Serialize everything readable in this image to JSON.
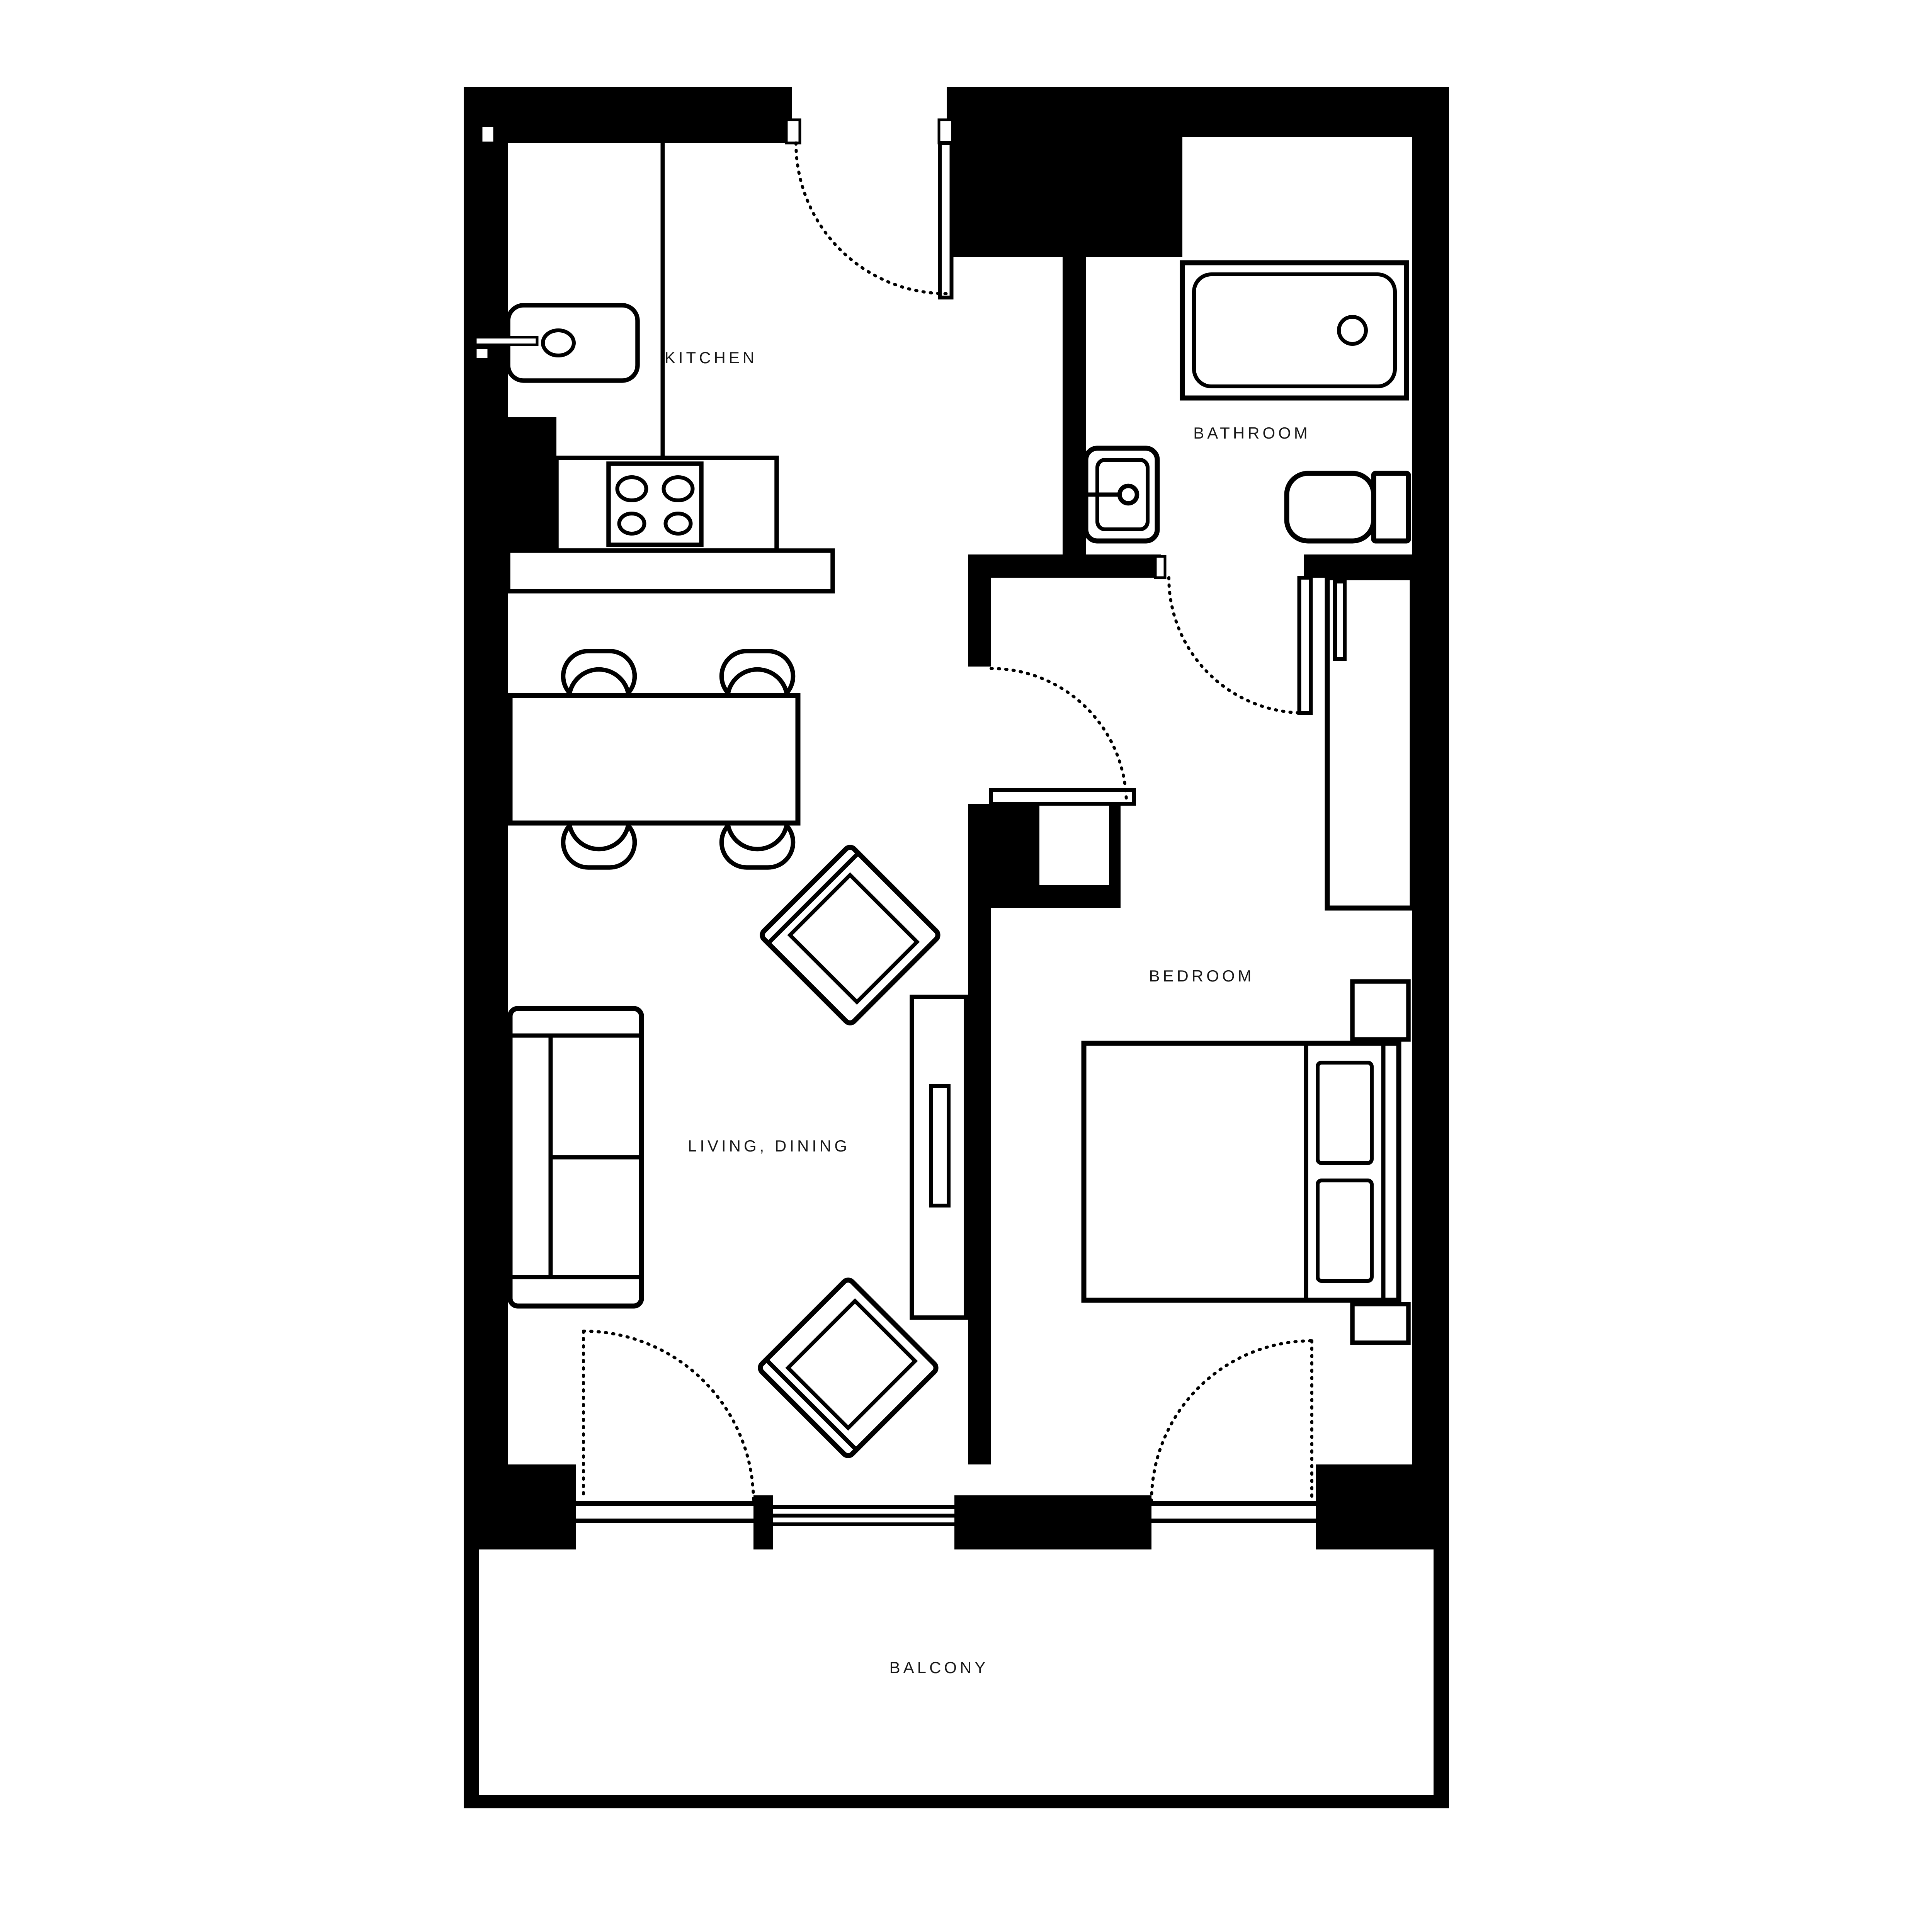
{
  "plan_type": "apartment floor plan",
  "colors": {
    "background": "#ffffff",
    "walls": "#000000",
    "furniture_outline": "#000000",
    "label_text": "#161616"
  },
  "rooms": {
    "kitchen": {
      "label": "KITCHEN"
    },
    "bathroom": {
      "label": "BATHROOM"
    },
    "living_dining": {
      "label": "LIVING, DINING"
    },
    "bedroom": {
      "label": "BEDROOM"
    },
    "balcony": {
      "label": "BALCONY"
    }
  },
  "fixtures": {
    "kitchen": [
      "kitchen sink with faucet",
      "counter",
      "stove with 4 burners",
      "counter bar"
    ],
    "bathroom": [
      "bathtub with drain",
      "wash basin with faucet",
      "toilet with cistern"
    ],
    "living_dining": [
      "dining table",
      "4 dining chairs",
      "3-seat sofa",
      "2 rotated armchairs",
      "tv console with tv"
    ],
    "bedroom": [
      "double bed with 2 pillows",
      "2 bedside tables",
      "wardrobe"
    ],
    "doors": [
      "entry door (top)",
      "bathroom door",
      "bedroom door",
      "balcony door from living room",
      "balcony door from bedroom"
    ],
    "windows": [
      "living room window to balcony"
    ]
  }
}
